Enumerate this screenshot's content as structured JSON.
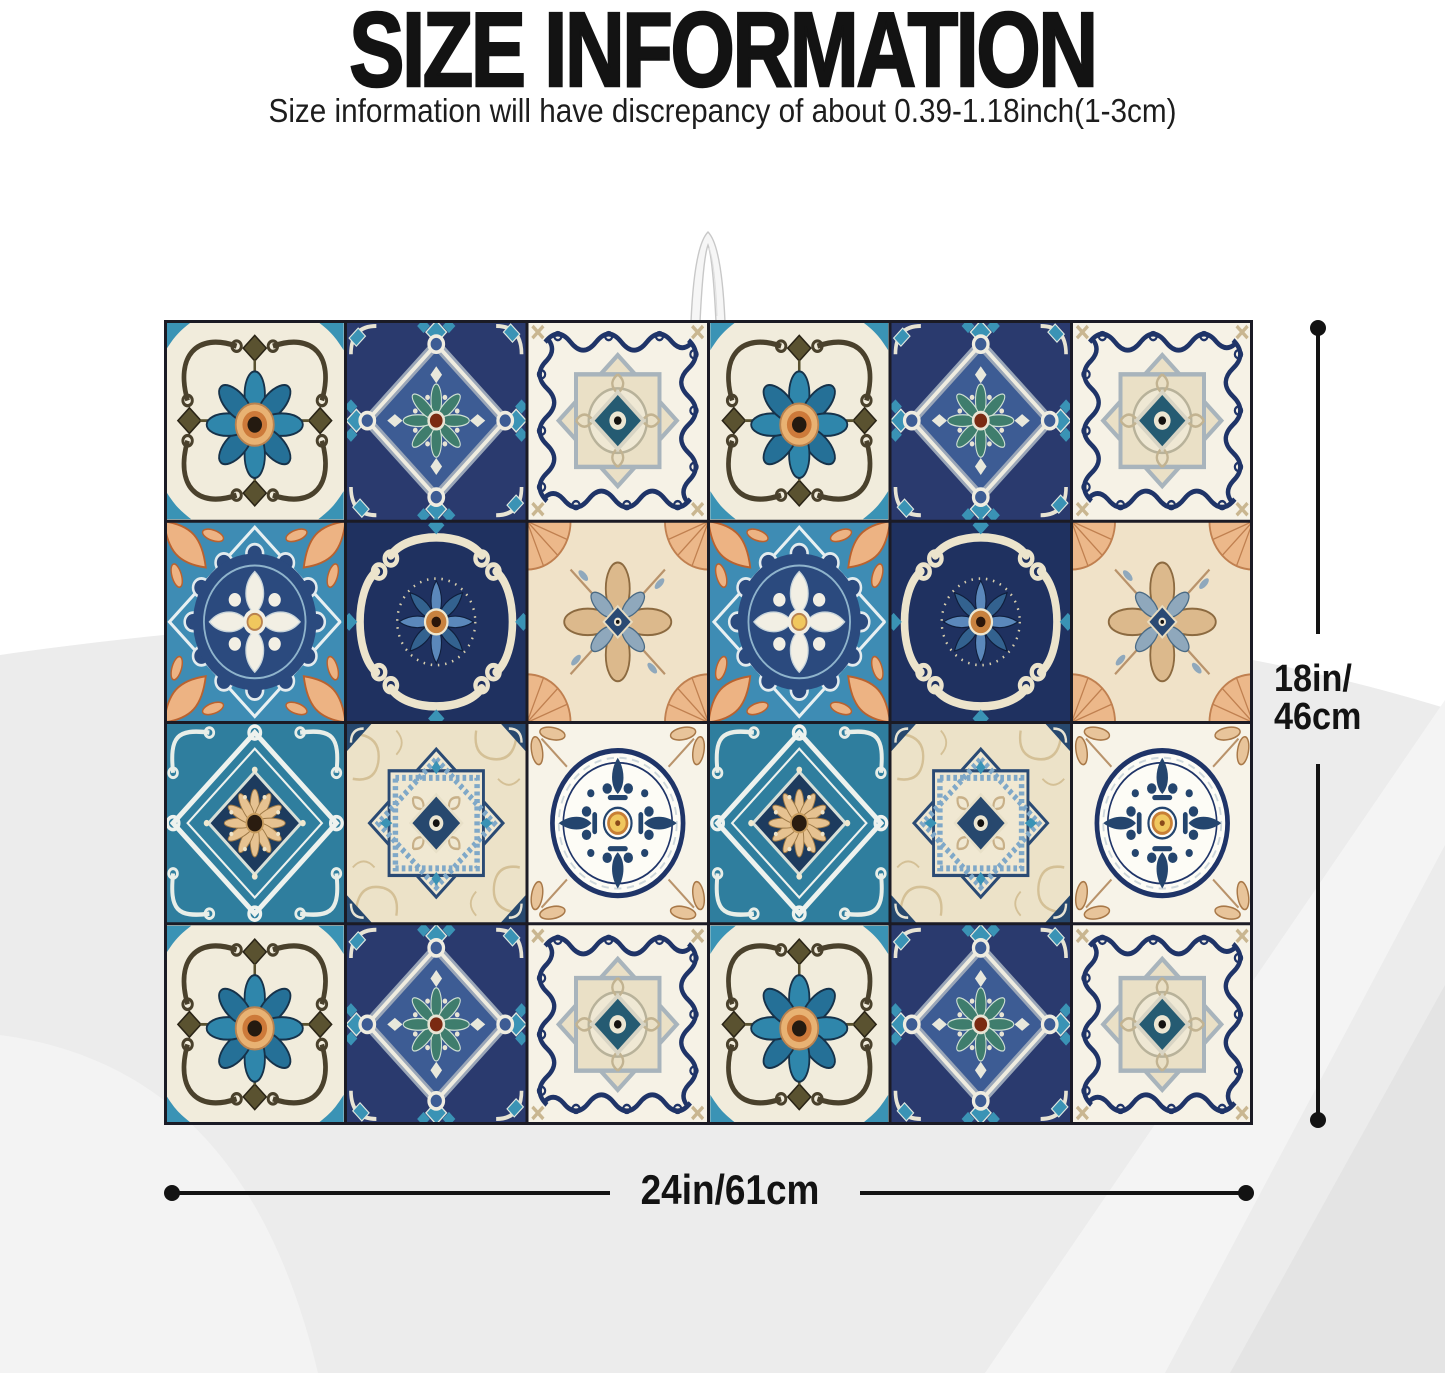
{
  "header": {
    "title": "SIZE INFORMATION",
    "subtitle": "Size information will have discrepancy of about 0.39-1.18inch(1-3cm)"
  },
  "dimensions": {
    "height_label_line1": "18in/",
    "height_label_line2": "46cm",
    "width_label": "24in/61cm"
  },
  "product": {
    "type": "dish-drying-mat-with-moroccan-tile-pattern",
    "hanging_loop": "white-ribbon-loop-top-center",
    "grid_rows": 4,
    "grid_cols": 6,
    "tile_grid": [
      [
        "flower-white",
        "navy-diamond",
        "scroll-star",
        "flower-white",
        "navy-diamond",
        "scroll-star"
      ],
      [
        "azure-medallion",
        "navy-scroll-flower",
        "cream-fan-flower",
        "azure-medallion",
        "navy-scroll-flower",
        "cream-fan-flower"
      ],
      [
        "teal-lattice-sunflower",
        "lace-star",
        "circle-fleur",
        "teal-lattice-sunflower",
        "lace-star",
        "circle-fleur"
      ],
      [
        "flower-white",
        "navy-diamond",
        "scroll-star",
        "flower-white",
        "navy-diamond",
        "scroll-star"
      ]
    ]
  },
  "palette": {
    "text": "#131313",
    "dimension_line": "#131313",
    "background_wave": "#ececec",
    "grout": "#1b1b25",
    "navy": "#2a3a6e",
    "navy_deep": "#1f3160",
    "azure": "#3a93b5",
    "azure_bg": "#3e8cb4",
    "teal": "#2f7e9e",
    "teal_green": "#3f7d6d",
    "cream": "#f1ecdc",
    "cream_dark": "#ece2c8",
    "tan": "#c9b690",
    "peach": "#ecb88a",
    "orange": "#cd7a3a",
    "yellow": "#f0c75e",
    "red_brown": "#7a2a12"
  }
}
